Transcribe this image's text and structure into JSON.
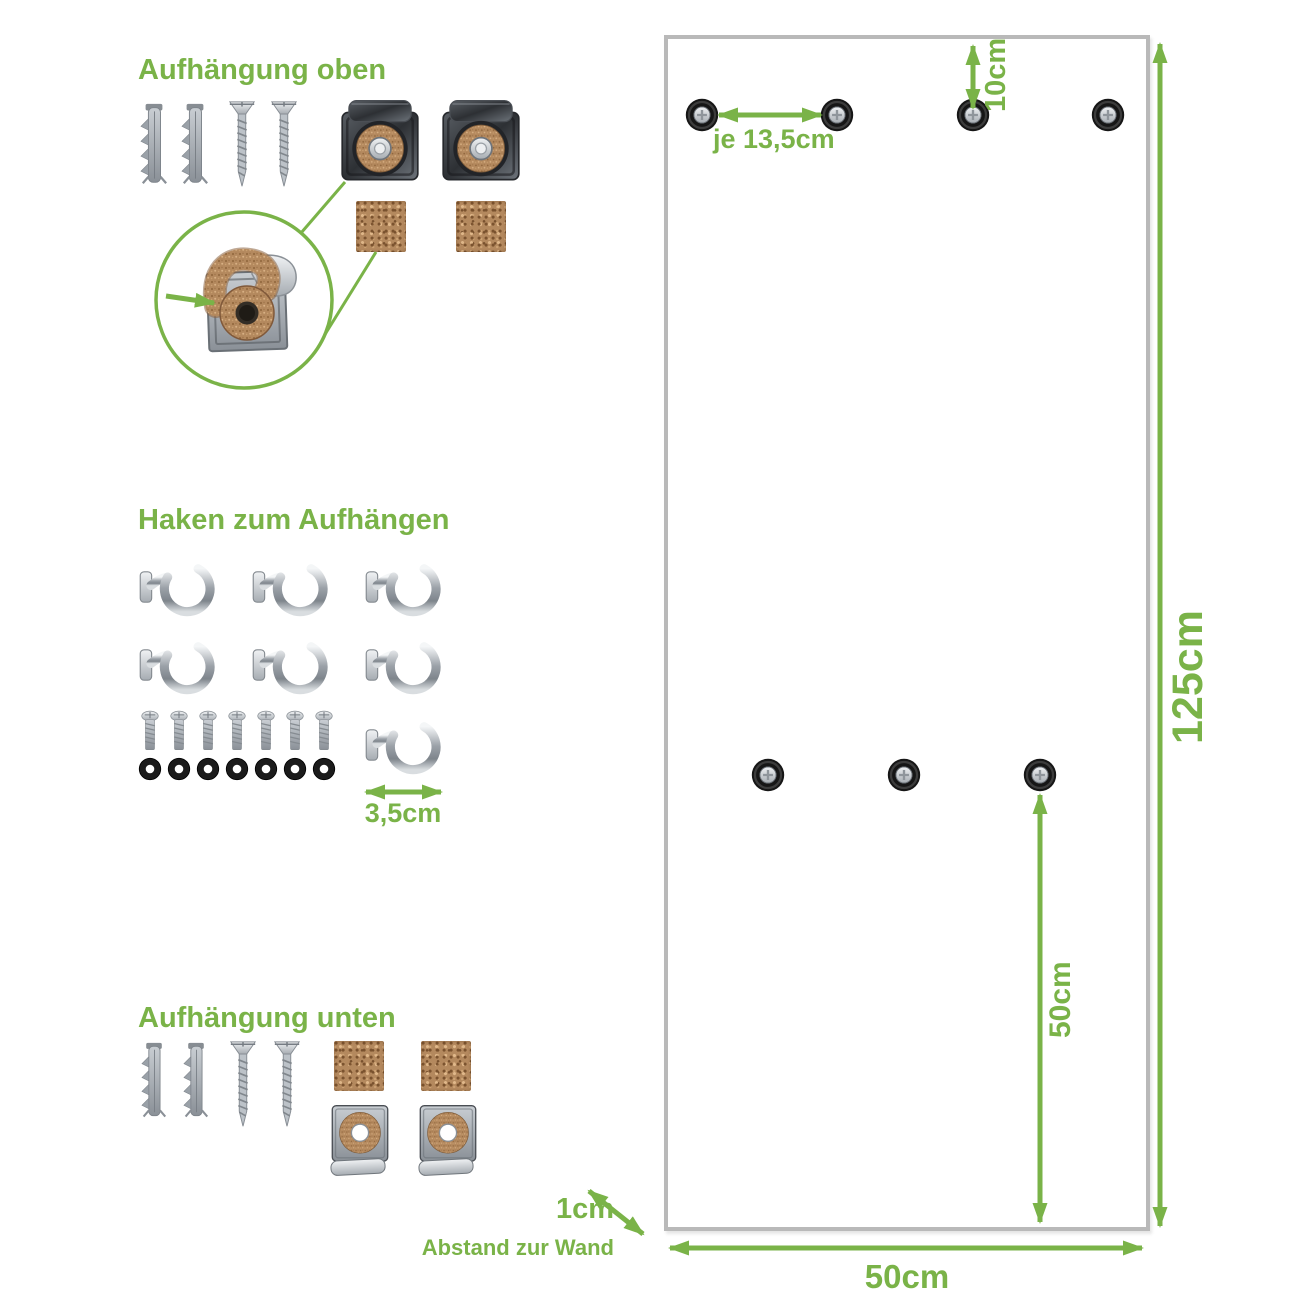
{
  "colors": {
    "accent": "#7ab348",
    "panel_border": "#b9b9b9"
  },
  "labels": {
    "section_top_title": "Aufhängung oben",
    "section_hooks_title": "Haken zum Aufhängen",
    "section_bottom_title": "Aufhängung unten",
    "hook_size": "3,5cm",
    "hole_spacing": "je 13,5cm",
    "top_offset": "10cm",
    "panel_height": "125cm",
    "hole_to_bottom": "50cm",
    "panel_width": "50cm",
    "wall_distance": "1cm",
    "wall_distance_caption": "Abstand zur Wand"
  },
  "hardware": {
    "top_mount": {
      "wall_plugs": 2,
      "screws": 2,
      "glass_clips": 2,
      "cork_pads": 2
    },
    "hooks": {
      "total": 7,
      "row1": 3,
      "row2": 3,
      "row3": 1
    },
    "bolts": 7,
    "washers": 7,
    "bottom_mount": {
      "wall_plugs": 2,
      "screws": 2,
      "cork_pads": 2,
      "glass_clips": 2
    }
  },
  "panel_holes": {
    "top_row": 4,
    "middle_row": 3
  }
}
